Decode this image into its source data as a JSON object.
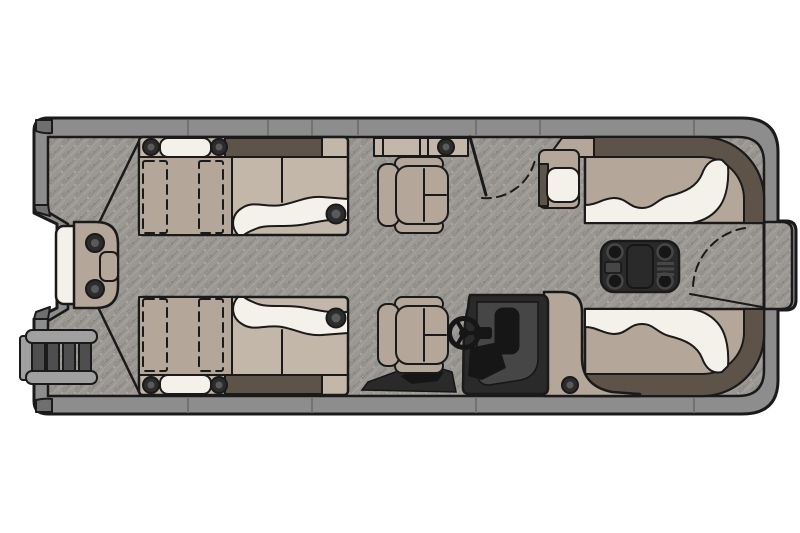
{
  "figure": {
    "type": "boat-floorplan",
    "subject": "pontoon boat deck plan, top-down view",
    "orientation": "bow at left, stern at right"
  },
  "palette": {
    "page-bg": "#ffffff",
    "outline": "#1a1a1a",
    "carpet": "#9b9893",
    "carpet-dark": "#8a8781",
    "carpet-light": "#a9a6a1",
    "rail": "#8d8d8d",
    "rail-cap": "#6f6f6f",
    "upholstery": "#b4a799",
    "upholstery-light": "#c3b7a9",
    "cream": "#f4f1ea",
    "walnut": "#5e5348",
    "console-dark": "#2a2a2a",
    "console-mid": "#464646",
    "console-black": "#161616",
    "metal": "#a0a0a0",
    "metal-dark": "#4e4e4e",
    "bolt": "#2c2c2c",
    "bolt-inner": "#5a5a5a"
  },
  "parts": {
    "hull": "pontoon hull with fence rails",
    "bow_ladder": "bow boarding ladder",
    "bow_gate_seat": "bow gate step with cushion",
    "bow_lounge_top": "port bow chaise lounge",
    "bow_lounge_bottom": "starboard bow chaise lounge",
    "side_console_top": "port side console with cup holder",
    "entry_gate_top": "port entry gate with swing arc",
    "captain_chair_top": "companion captain chair",
    "helm_chair": "helm captain chair",
    "helm_console": "helm console with steering wheel",
    "stern_lounge_top": "port stern wraparound lounge",
    "stern_lounge_bottom": "starboard stern wraparound lounge",
    "stern_arm_console": "stern arm console with lid",
    "stern_table": "removable stern table with four cup holders",
    "stern_gate": "stern gate with swing arc",
    "swim_platform": "rear boarding platform"
  }
}
